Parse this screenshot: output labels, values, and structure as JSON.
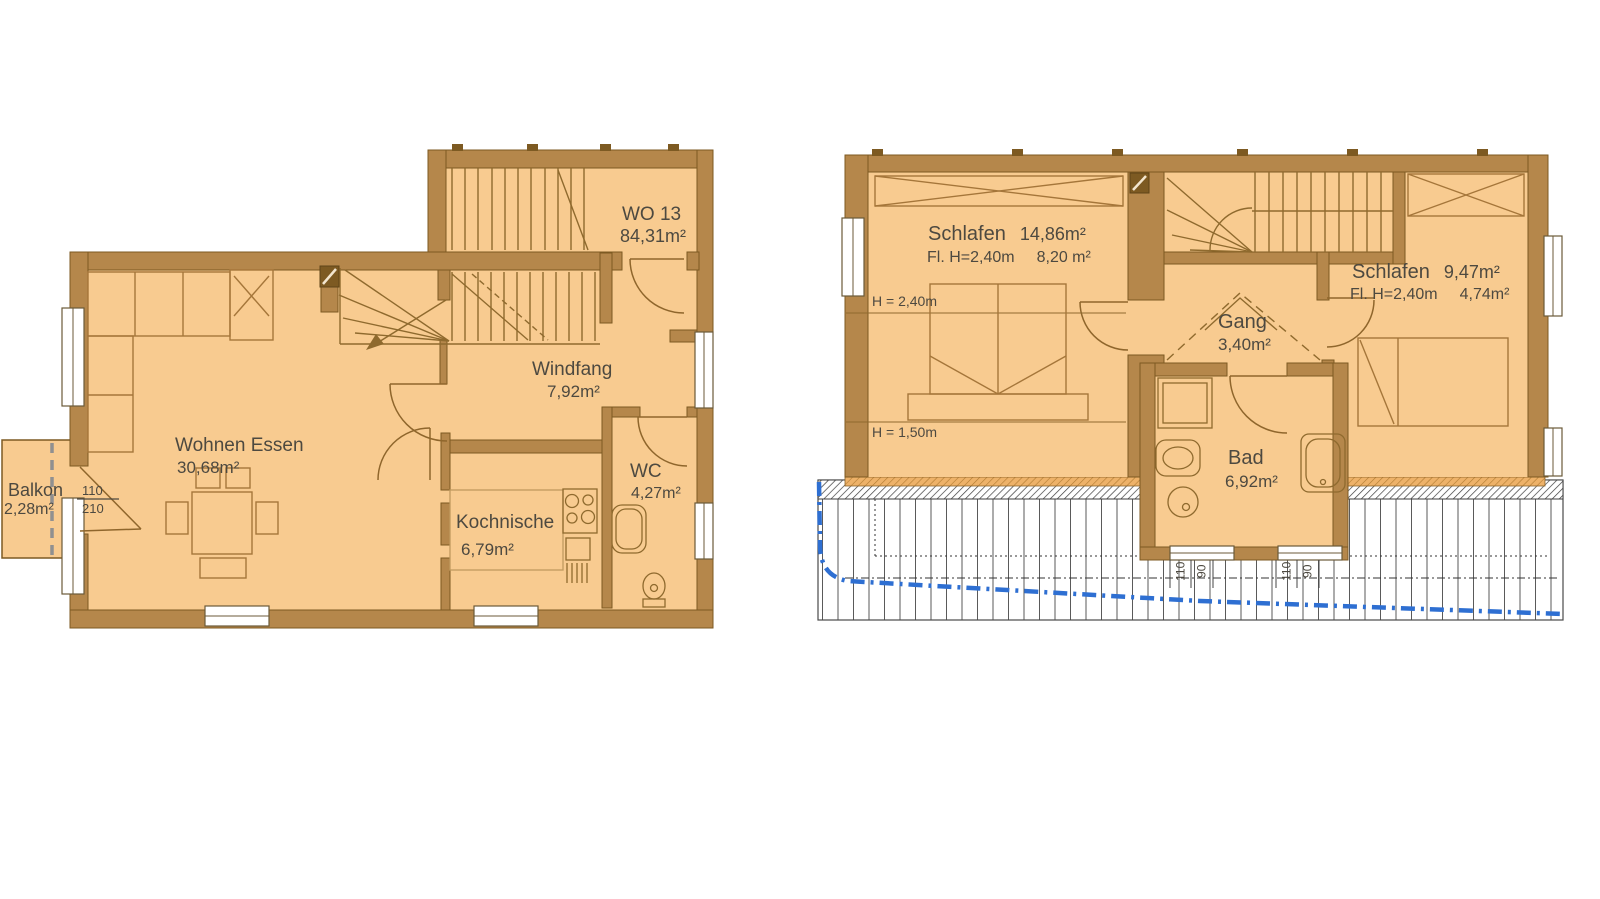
{
  "title": "Floor plan apartment WO 13 (ground floor and attic floor)",
  "colors": {
    "floor_fill": "#f8cb90",
    "wall_fill": "#b5874b",
    "wall_edge": "#7d5a22",
    "drawing_line": "#8f6a2e",
    "terrace_line": "#5a5a5a",
    "roof_edge_blue": "#2e6fd2",
    "balcony_divider_gray": "#909090",
    "text": "#4d4940"
  },
  "ground_floor": {
    "unit_number": "WO 13",
    "unit_area": "84,31m²",
    "living": {
      "name": "Wohnen Essen",
      "area": "30,68m²"
    },
    "vestibule": {
      "name": "Windfang",
      "area": "7,92m²"
    },
    "kitchen": {
      "name": "Kochnische",
      "area": "6,79m²"
    },
    "wc": {
      "name": "WC",
      "area": "4,27m²"
    },
    "balcony": {
      "name": "Balkon",
      "area": "2,28m²"
    },
    "balcony_door": {
      "width": "110",
      "height": "210"
    }
  },
  "upper_floor": {
    "bedroom_left": {
      "name": "Schlafen",
      "area": "14,86m²",
      "detail_label": "Fl. H=2,40m",
      "detail_area": "8,20 m²"
    },
    "bedroom_right": {
      "name": "Schlafen",
      "area": "9,47m²",
      "detail_label": "Fl. H=2,40m",
      "detail_area": "4,74m²"
    },
    "hall": {
      "name": "Gang",
      "area": "3,40m²"
    },
    "bath": {
      "name": "Bad",
      "area": "6,92m²"
    },
    "height_line_upper": "H = 2,40m",
    "height_line_lower": "H = 1,50m",
    "bath_window_dims": {
      "d1": "110",
      "d2": "90",
      "d3": "110",
      "d4": "90"
    }
  }
}
